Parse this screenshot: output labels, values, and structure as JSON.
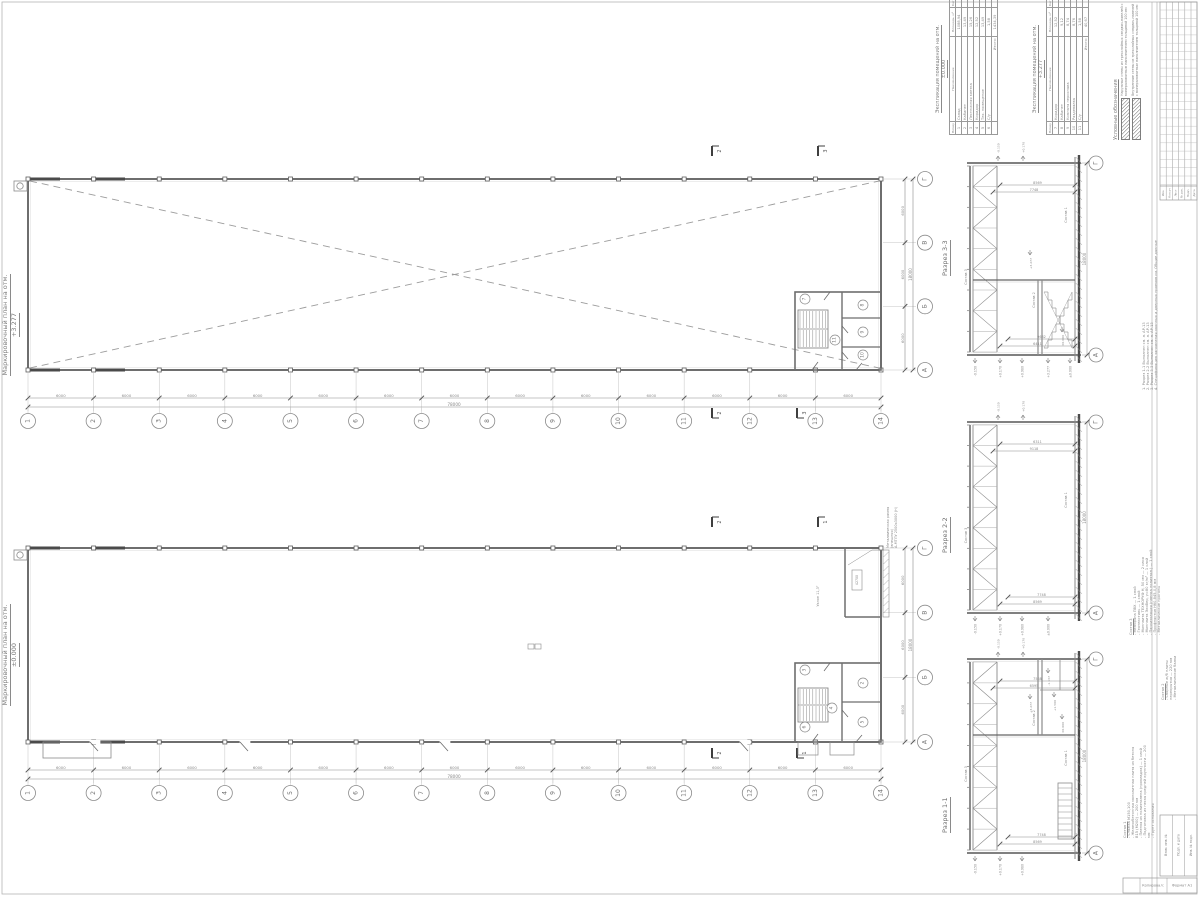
{
  "palette": {
    "line": "#8a8a8a",
    "dark": "#4f4f4f",
    "mid": "#6e6e6e",
    "text": "#8a8a8a",
    "faint": "#c4c4c4"
  },
  "plans": {
    "grid_numbers": [
      "1",
      "2",
      "3",
      "4",
      "5",
      "6",
      "7",
      "8",
      "9",
      "10",
      "11",
      "12",
      "13",
      "14"
    ],
    "grid_letters": [
      "Г",
      "В",
      "Б",
      "А"
    ],
    "bay_dim": "6000",
    "total_dim": "78000",
    "side_bay_dim": "6000",
    "side_total_dim": "18000",
    "upper": {
      "title_line1": "Маркировочный план на отм.",
      "title_line2": "+3.277",
      "rooms": [
        "7",
        "8",
        "9",
        "10",
        "11"
      ],
      "cut_labels": [
        "2",
        "3"
      ]
    },
    "lower": {
      "title_line1": "Маркировочный план на отм.",
      "title_line2": "±0.000",
      "rooms": [
        "3",
        "2",
        "4",
        "5",
        "6"
      ],
      "cut_labels": [
        "2",
        "1"
      ],
      "ramp_note_line1": "Металлическая рампа (внешняя)",
      "ramp_note_line2": "А-МТЛУ 2500х3000 (Н)",
      "slope_label": "Уклон 11,3°",
      "ramp_dim": "42700"
    }
  },
  "sections": [
    {
      "label": "Разрез 3-3",
      "total_dim": "18000",
      "bubble_top": "Г",
      "bubble_bottom": "А",
      "dims_top": [
        "8569",
        "7748"
      ],
      "dims_bottom": [
        "9632",
        "6411"
      ],
      "elevations": [
        "-0.150",
        "+0.170",
        "+0.980",
        "+3.277",
        "±0.000"
      ],
      "above": [
        "-0.150",
        "+0.170"
      ],
      "tags": {
        "roof": "Состав 3",
        "floor": "Состав 1",
        "mezz": "Состав 2"
      },
      "inner_marks": [
        [
          "+3.277",
          1030,
          258
        ],
        [
          "±0.000",
          1062,
          335
        ]
      ]
    },
    {
      "label": "Разрез 2-2",
      "total_dim": "18000",
      "bubble_top": "Г",
      "bubble_bottom": "А",
      "dims_top": [
        "6311",
        "9118"
      ],
      "dims_bottom": [
        "7748",
        "8569"
      ],
      "elevations": [
        "-0.150",
        "+0.170",
        "+0.980",
        "±0.000"
      ],
      "above": [
        "-0.150",
        "+0.170"
      ],
      "tags": {
        "roof": "Состав 3",
        "floor": "Состав 1"
      },
      "inner_marks": []
    },
    {
      "label": "Разрез 1-1",
      "total_dim": "18000",
      "bubble_top": "Г",
      "bubble_bottom": "А",
      "dims_top": [
        "7568",
        "6595"
      ],
      "dims_bottom": [
        "7748",
        "8569"
      ],
      "elevations": [
        "-0.150",
        "+0.170",
        "+0.980"
      ],
      "above": [
        "-0.150",
        "+0.170"
      ],
      "tags": {
        "roof": "Состав 3",
        "floor": "Состав 1",
        "mezz": "Состав 2"
      },
      "inner_marks": [
        [
          "-1.137",
          1048,
          676
        ],
        [
          "+1.500",
          1054,
          700
        ],
        [
          "+3.277",
          1030,
          702
        ],
        [
          "±0.000",
          1062,
          722
        ]
      ]
    }
  ],
  "tables": [
    {
      "title_line1": "Экспликация помещений на отм.",
      "title_line2": "±0.000",
      "headers": [
        "Номер помещ.",
        "Наименование",
        "Площадь, м²",
        "Кат. пом."
      ],
      "rows": [
        [
          "1",
          "Склад",
          "1088,94"
        ],
        [
          "2",
          "Кабинет",
          "13,49"
        ],
        [
          "3",
          "Лестничная клетка",
          "15,26"
        ],
        [
          "4",
          "Коридор",
          "12,52"
        ],
        [
          "5",
          "Тех. помещение",
          "13,49"
        ],
        [
          "6",
          "С/у",
          "1,58"
        ]
      ],
      "total_label": "Итого:",
      "total_value": "1434,39"
    },
    {
      "title_line1": "Экспликация помещений на отм.",
      "title_line2": "+3.277",
      "headers": [
        "Номер помещ.",
        "Наименование",
        "Площадь, м²",
        "Кат. пом."
      ],
      "rows": [
        [
          "7",
          "Коридор",
          "12,52"
        ],
        [
          "8",
          "Кабинет",
          "9,12"
        ],
        [
          "9",
          "Комната персонала",
          "8,74"
        ],
        [
          "10",
          "Раздевалка",
          "8,76"
        ],
        [
          "11",
          "С/у",
          "1,58"
        ]
      ],
      "total_label": "Итого:",
      "total_value": "40,67"
    }
  ],
  "legend": {
    "title": "Условные обозначения",
    "items": [
      {
        "name": "outer-wall",
        "text": "Наружные стены из трехслойных сэндвич-панелей с минераловатным наполнителем толщиной 100 мм"
      },
      {
        "name": "inner-wall",
        "text": "Внутренние стены из трехслойных сэндвич-панелей с минераловатным наполнителем толщиной 100 мм"
      }
    ]
  },
  "notes": {
    "items": [
      "1. Разрез 1-1 Выполнен см. л. АР-13",
      "2. Разрез 2-2 Выполнен см. л. АР-13",
      "3. Разрез 3-3 Выполнен см. л. АР-13",
      "4. Спецификацию заполнения оконных и дверных проемов см. Общие данные"
    ]
  },
  "compositions": [
    {
      "title": "Состав 3",
      "items": [
        "- Мембрана ПВХ — 1 слой",
        "- Геотекстиль — 1 слой",
        "- Минплита ТЕХНОРУФ Н, 50 мм — 2 слоя",
        "- Минплита ЭкоВер, γ=80 кг/м³ — 1 слой",
        "- Пароизоляция (пленка полиэтил.) — 1 слой",
        "- Профнастил Н60-845-0,8 мм",
        "- Металлические прогоны"
      ]
    },
    {
      "title": "Состав 2",
      "items": [
        "- Сборные ж/б плиты перекрытия — 220 мм",
        "- Металлические балки"
      ]
    },
    {
      "title": "Состав 1",
      "items": [
        "- Стяжка М150,100",
        "- Железобетонная монолитная плита из бетона В15 (М200) — 200 мм",
        "- Пленка из полиэтилена (прокладка) — 1 слой",
        "- Подготовка из песка средней крупности — 200 мм",
        "- Грунт основания"
      ]
    }
  ],
  "stamp": {
    "revision_headers": [
      "Изм.",
      "Кол.уч",
      "Лист",
      "№ док.",
      "Подп.",
      "Дата"
    ],
    "margin_fields": [
      "Взам. инв. №",
      "Подп. и дата",
      "Инв. № подл."
    ],
    "footer_left": "Копировал:",
    "footer_right": "Формат А1"
  }
}
